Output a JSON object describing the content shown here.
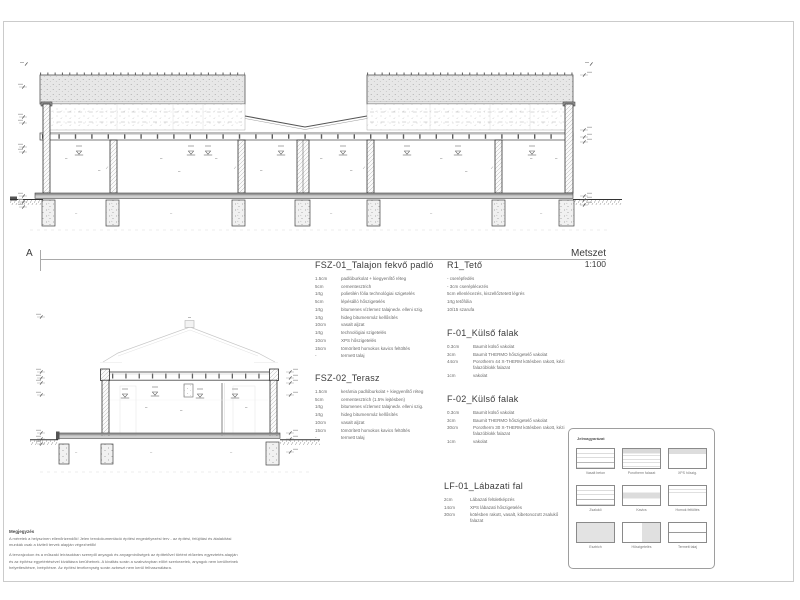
{
  "titleblock": {
    "section_mark": "A",
    "title": "Metszet",
    "scale": "1:100"
  },
  "specs": {
    "fsz01": {
      "title": "FSZ-01_Talajon fekvő padló",
      "layers": [
        {
          "qty": "1.5cm",
          "desc": "padlóburkolat + kiegyenlítő réteg"
        },
        {
          "qty": "5cm",
          "desc": "cementesztrich"
        },
        {
          "qty": "1rtg",
          "desc": "polietilén fólia technológiai szigetelés"
        },
        {
          "qty": "5cm",
          "desc": "lépésálló hőszigetelés"
        },
        {
          "qty": "1rtg",
          "desc": "bitumenes vízlemez talajnedv. elleni szig."
        },
        {
          "qty": "1rtg",
          "desc": "hideg bitumenmáz kellősítés"
        },
        {
          "qty": "10cm",
          "desc": "vasalt aljzat"
        },
        {
          "qty": "1rtg",
          "desc": "technológiai szigetelés"
        },
        {
          "qty": "10cm",
          "desc": "XPS hőszigetelés"
        },
        {
          "qty": "15cm",
          "desc": "tömörített homokos kavics feltöltés"
        },
        {
          "qty": "-",
          "desc": "termett talaj"
        }
      ]
    },
    "fsz02": {
      "title": "FSZ-02_Terasz",
      "layers": [
        {
          "qty": "1.5cm",
          "desc": "kerámia padlóburkolat + kiegyenlítő réteg"
        },
        {
          "qty": "5cm",
          "desc": "cementesztrich (1.5% lejtésben)"
        },
        {
          "qty": "1rtg",
          "desc": "bitumenes vízlemez talajnedv. elleni szig."
        },
        {
          "qty": "1rtg",
          "desc": "hideg bitumenmáz kellősítés"
        },
        {
          "qty": "10cm",
          "desc": "vasalt aljzat"
        },
        {
          "qty": "15cm",
          "desc": "tömörített homokos kavics feltöltés"
        },
        {
          "qty": "-",
          "desc": "termett talaj"
        }
      ]
    },
    "r1": {
      "title": "R1_Tető",
      "lines": [
        {
          "text": "- cserépfedés"
        },
        {
          "text": "- 3cm cseréplécezés"
        },
        {
          "text": "5cm ellenlécezés, kiszellőztetett légrés"
        },
        {
          "text": "1rtg tetőfólia"
        },
        {
          "text": "10/15 szarufa"
        }
      ]
    },
    "f01": {
      "title": "F-01_Külső falak",
      "layers": [
        {
          "qty": "0.3cm",
          "desc": "Baumit külső vakolat"
        },
        {
          "qty": "3cm",
          "desc": "Baumit THERMO hőszigetelő vakolat"
        },
        {
          "qty": "44cm",
          "desc": "Porotherm 44 X-THERM kötésben rakott, kézi falazóblokk falazat"
        },
        {
          "qty": "1cm",
          "desc": "vakolat"
        }
      ]
    },
    "f02": {
      "title": "F-02_Külső falak",
      "layers": [
        {
          "qty": "0.3cm",
          "desc": "Baumit külső vakolat"
        },
        {
          "qty": "3cm",
          "desc": "Baumit THERMO hőszigetelő vakolat"
        },
        {
          "qty": "30cm",
          "desc": "Porotherm 30 X-THERM kötésben rakott, kézi falazóblokk falazat"
        },
        {
          "qty": "1cm",
          "desc": "vakolat"
        }
      ]
    },
    "lf01": {
      "title": "LF-01_Lábazati fal",
      "layers": [
        {
          "qty": "2cm",
          "desc": "Lábazati felületképzés"
        },
        {
          "qty": "14cm",
          "desc": "XPS lábazati hőszigetelés"
        },
        {
          "qty": "30cm",
          "desc": "kötésben rakott, vasalt, kibetonozott zsalukő falazat"
        }
      ]
    }
  },
  "legend": {
    "title": "Jelmagyarázat",
    "items": [
      {
        "label": "Vasalt beton"
      },
      {
        "label": "Porotherm falazat"
      },
      {
        "label": "XPS hőszig."
      },
      {
        "label": "Zsalukő"
      },
      {
        "label": "Kavics"
      },
      {
        "label": "Homok feltöltés"
      },
      {
        "label": "Esztrich"
      },
      {
        "label": "Hőszigetelés"
      },
      {
        "label": "Termett talaj"
      }
    ]
  },
  "notes": {
    "title": "Megjegyzés",
    "paragraphs": [
      "A méretek a helyszínen ellenőrizendők! Jelen tervdokumentáció építési engedélyezési terv - az építési, felújítási és átalakítási munkák csak a kiviteli tervek alapján végezhetők!",
      "A tervrajzokon és a műszaki leírásokban szereplő anyagok és anyagminőségek az építtetővel történt előzetes egyeztetés alapján és az építész egyetértésével kiváltásra kerülhetnek. A kiváltás során a szabványban előírt szerkezetek, anyagok nem kerülhetnek helyettesítésre, beépítésre. Az építési tevékenység során azbeszt nem kerül felhasználásra."
    ]
  },
  "colors": {
    "line": "#4a4a4a",
    "hatch_fill": "#e7e7e7",
    "faint": "#c8c8c8"
  }
}
